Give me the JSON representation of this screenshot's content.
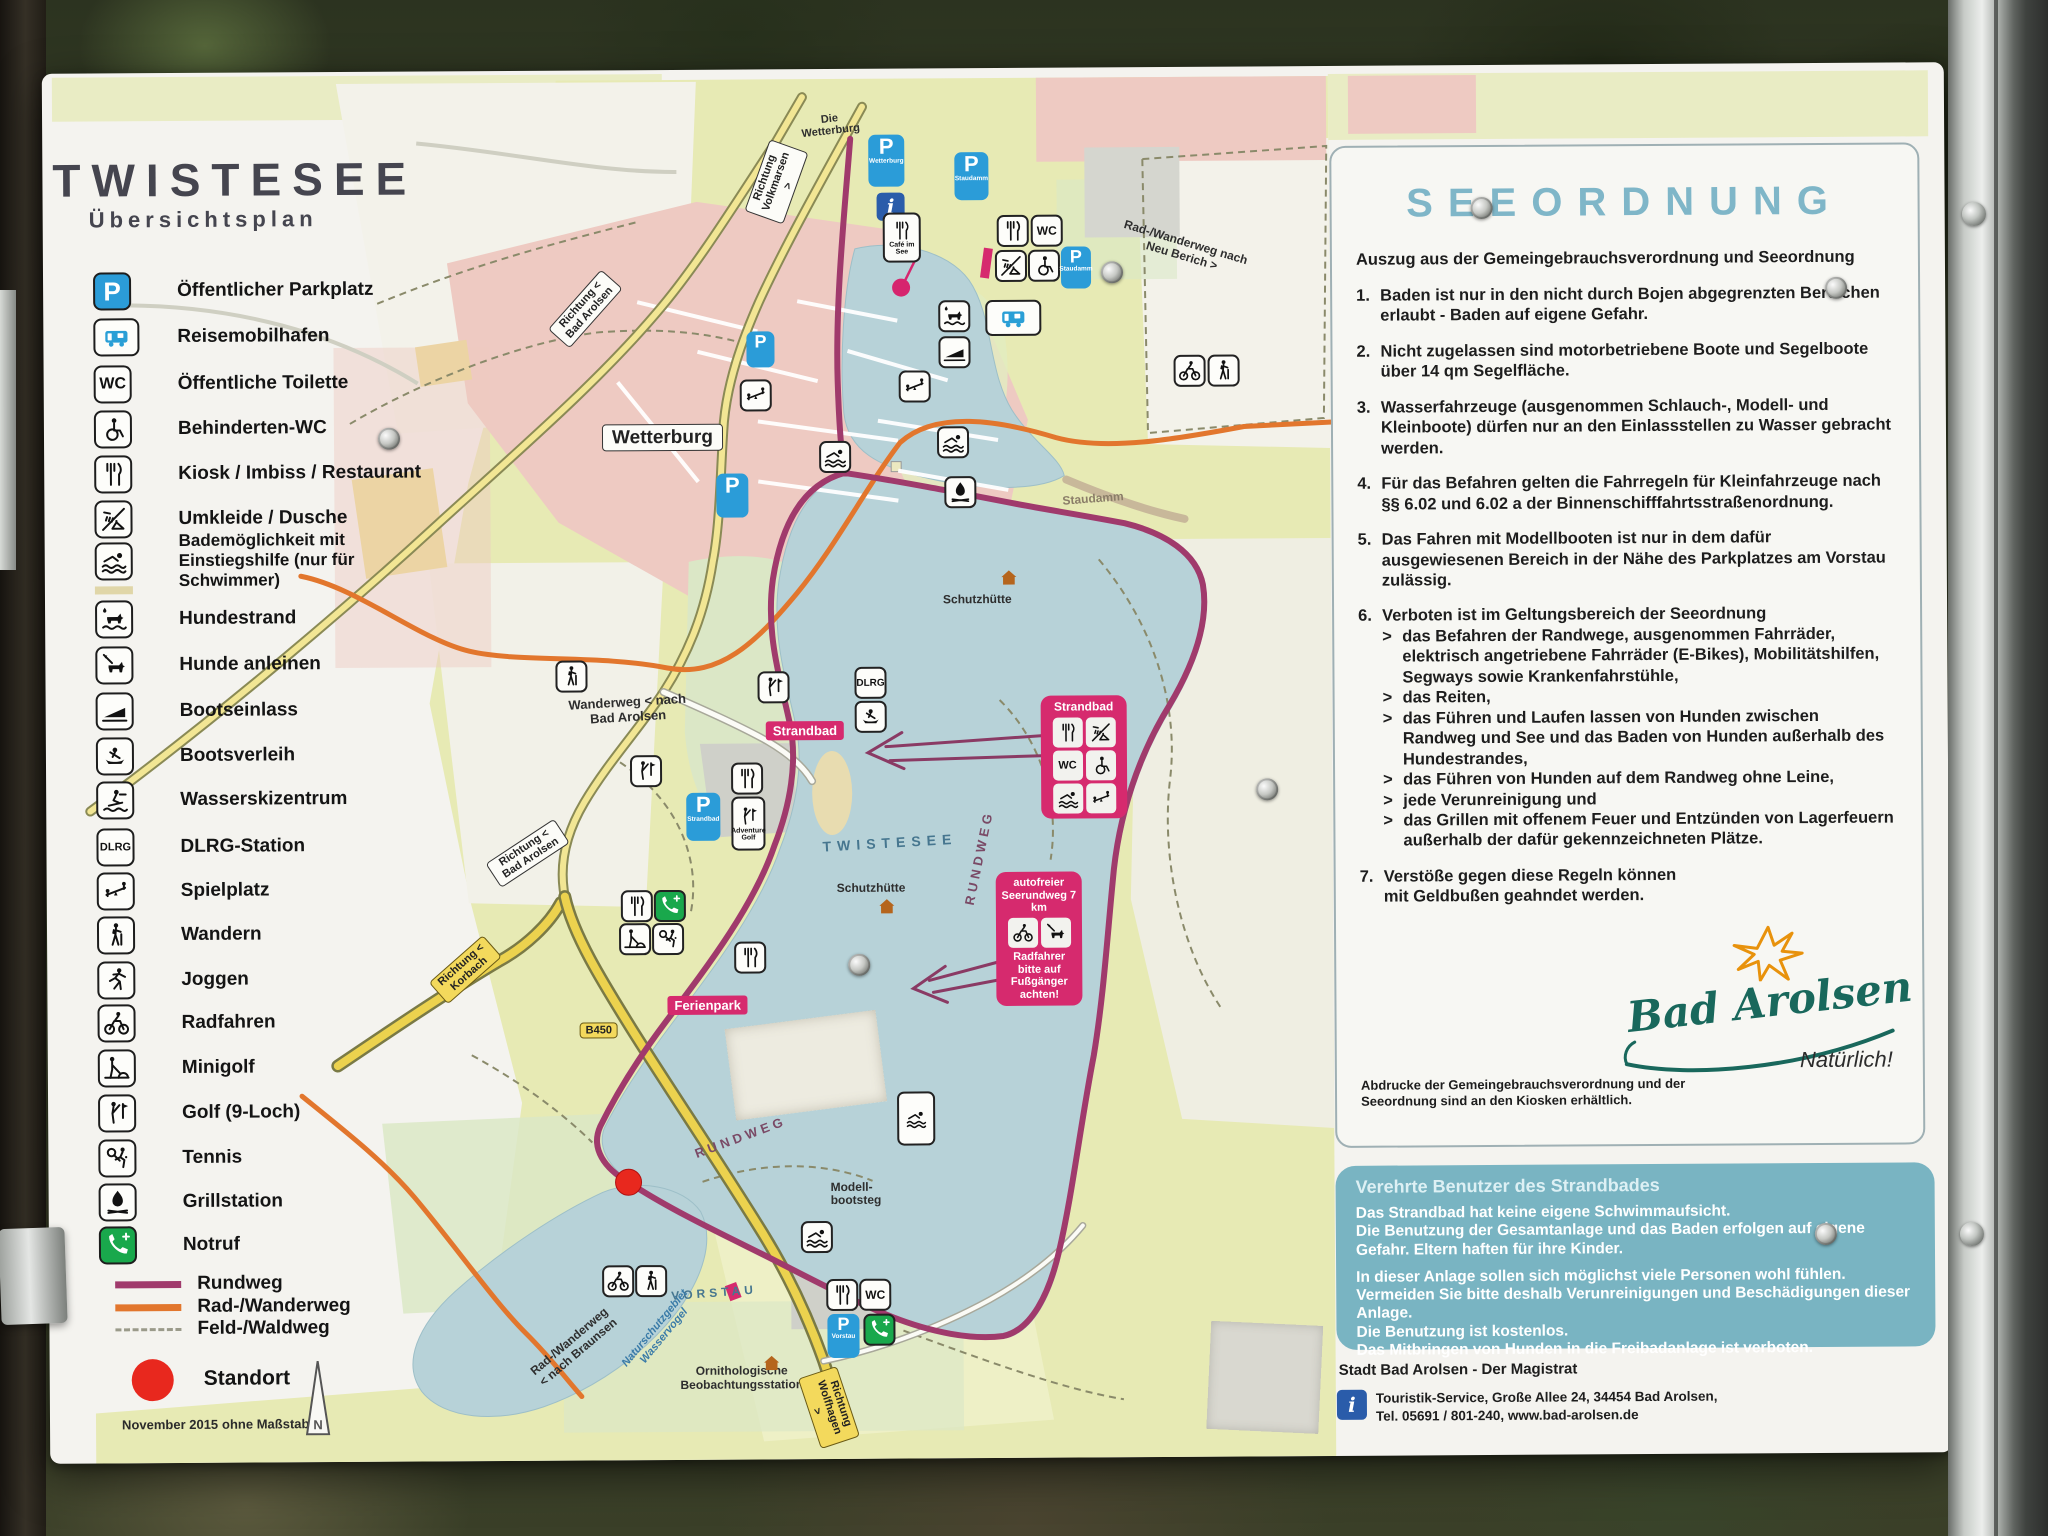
{
  "colors": {
    "seeordnung_title": "#7fb6c8",
    "notice_bg": "#79b4c2",
    "pink_box": "#d62a6e",
    "rundweg": "#a03a6c",
    "rad_wanderweg": "#e2762d",
    "feld_waldweg": "#9a9a8a",
    "standort": "#e8281e",
    "parking_blue": "#2b9cd8",
    "notruf_green": "#19a84c",
    "lake": "#b7d2d8"
  },
  "board": {
    "title": "TWISTESEE",
    "subtitle": "Übersichtsplan",
    "date": "November 2015",
    "scale_note": "ohne Maßstab"
  },
  "glyphs": {
    "p": "P",
    "wc": "WC",
    "dlrg": "DLRG",
    "fkk": "FKK",
    "i": "i",
    "north": "N"
  },
  "legend": {
    "items": [
      {
        "icon": "parking-icon",
        "label": "Öffentlicher Parkplatz"
      },
      {
        "icon": "rv-icon",
        "label": "Reisemobilhafen"
      },
      {
        "icon": "wc-icon",
        "label": "Öffentliche Toilette"
      },
      {
        "icon": "wheelchair-icon",
        "label": "Behinderten-WC"
      },
      {
        "icon": "restaurant-icon",
        "label": "Kiosk / Imbiss / Restaurant"
      },
      {
        "icon": "shower-icon",
        "label": "Umkleide / Dusche"
      },
      {
        "icon": "swimmer-icon",
        "label": "Bademöglichkeit mit Einstiegshilfe (nur für Schwimmer)"
      },
      {
        "icon": "dog-beach-icon",
        "label": "Hundestrand"
      },
      {
        "icon": "dog-leash-icon",
        "label": "Hunde anleinen"
      },
      {
        "icon": "boat-ramp-icon",
        "label": "Bootseinlass"
      },
      {
        "icon": "boat-rental-icon",
        "label": "Bootsverleih"
      },
      {
        "icon": "waterski-icon",
        "label": "Wasserskizentrum"
      },
      {
        "icon": "dlrg-icon",
        "label": "DLRG-Station"
      },
      {
        "icon": "playground-icon",
        "label": "Spielplatz"
      },
      {
        "icon": "hiking-icon",
        "label": "Wandern"
      },
      {
        "icon": "jogging-icon",
        "label": "Joggen"
      },
      {
        "icon": "cycling-icon",
        "label": "Radfahren"
      },
      {
        "icon": "minigolf-icon",
        "label": "Minigolf"
      },
      {
        "icon": "golf-icon",
        "label": "Golf (9-Loch)"
      },
      {
        "icon": "tennis-icon",
        "label": "Tennis"
      },
      {
        "icon": "grill-icon",
        "label": "Grillstation"
      },
      {
        "icon": "emergency-phone-icon",
        "label": "Notruf"
      }
    ],
    "routes": [
      {
        "label": "Rundweg",
        "color": "#a03a6c",
        "style": "solid"
      },
      {
        "label": "Rad-/Wanderweg",
        "color": "#e2762d",
        "style": "solid"
      },
      {
        "label": "Feld-/Waldweg",
        "color": "#9a9a8a",
        "style": "dashed"
      }
    ],
    "standort_label": "Standort"
  },
  "map": {
    "labels": {
      "die_wetterburg": "Die Wetterburg",
      "richtung_volkmarsen": "Richtung Volkmarsen >",
      "richtung_bad_arolsen_top": "Richtung < Bad Arolsen",
      "richtung_bad_arolsen_mid": "Richtung < Bad Arolsen",
      "richtung_korbach": "Richtung < Korbach",
      "richtung_wolfhagen": "Richtung Wolfhagen >",
      "wetterburg": "Wetterburg",
      "staudamm": "Staudamm",
      "cafe_im_see": "Café im See",
      "rad_wanderweg_neu_berich": "Rad-/Wanderweg nach Neu Berich >",
      "wanderweg_bad_arolsen": "Wanderweg < nach Bad Arolsen",
      "strandbad": "Strandbad",
      "twistesee": "TWISTESEE",
      "rundweg_east": "RUNDWEG",
      "rundweg_south": "RUNDWEG",
      "schutzhuette_1": "Schutzhütte",
      "schutzhuette_2": "Schutzhütte",
      "adventure_golf": "Adventure Golf",
      "ferienpark": "Ferienpark",
      "b450": "B450",
      "modellbootsteg": "Modell- bootsteg",
      "vorstau": "VORSTAU",
      "rad_wanderweg_braunsen": "Rad-/Wanderweg < nach Braunsen",
      "naturschutzgebiet": "Naturschutzgebiet Wasservogel",
      "ornithologische": "Ornithologische Beobachtungsstation",
      "p_wetterburg": "Wetterburg",
      "p_staudamm": "Staudamm",
      "p_strandbad": "Strandbad",
      "p_vorstau": "Vorstau"
    }
  },
  "strandbad_box": {
    "title": "Strandbad"
  },
  "seerundweg_box": {
    "title": "autofreier Seerundweg 7 km",
    "note": "Radfahrer bitte auf Fußgänger achten!"
  },
  "seeordnung": {
    "title": "SEEORDNUNG",
    "intro": "Auszug aus der Gemeingebrauchsverordnung und Seeordnung",
    "bullet": ">",
    "rules": [
      {
        "num": "1.",
        "text": "Baden ist nur in den nicht durch Bojen abgegrenzten Bereichen erlaubt - Baden auf eigene Gefahr."
      },
      {
        "num": "2.",
        "text": "Nicht zugelassen sind motorbetriebene Boote und Segelboote über 14 qm Segelfläche."
      },
      {
        "num": "3.",
        "text": "Wasserfahrzeuge (ausgenommen Schlauch-, Modell- und Kleinboote) dürfen nur an den Einlassstellen zu Wasser gebracht werden."
      },
      {
        "num": "4.",
        "text": "Für das Befahren gelten die Fahrregeln für Kleinfahrzeuge nach §§ 6.02 und 6.02 a der Binnenschifffahrtsstraßenordnung."
      },
      {
        "num": "5.",
        "text": "Das Fahren mit Modellbooten ist nur in dem dafür ausgewiesenen Bereich in der Nähe des Parkplatzes am Vorstau zulässig."
      },
      {
        "num": "6.",
        "text": "Verboten ist im Geltungsbereich der Seeordnung"
      },
      {
        "num": "7.",
        "text": "Verstöße gegen diese Regeln können mit Geldbußen geahndet werden."
      }
    ],
    "rule6_subs": [
      "das Befahren der Randwege, ausgenommen Fahrräder, elektrisch angetriebene Fahrräder (E-Bikes), Mobilitätshilfen, Segways sowie Krankenfahrstühle,",
      "das Reiten,",
      "das Führen und Laufen lassen von Hunden zwischen Randweg und See und das Baden von Hunden außerhalb des Hundestrandes,",
      "das Führen von Hunden auf dem Randweg ohne Leine,",
      "jede Verunreinigung und",
      "das Grillen mit offenem Feuer und Entzünden von Lagerfeuern außerhalb der dafür gekennzeichneten Plätze."
    ],
    "note": "Abdrucke der Gemeingebrauchsverordnung und der Seeordnung sind an den Kiosken erhältlich."
  },
  "branding": {
    "name": "Bad Arolsen",
    "tagline": "Natürlich!"
  },
  "notice": {
    "heading": "Verehrte Benutzer des Strandbades",
    "paras": [
      "Das Strandbad hat keine eigene Schwimmaufsicht.",
      "Die Benutzung der Gesamtanlage und das Baden erfolgen auf eigene Gefahr. Eltern haften für ihre Kinder.",
      "In dieser Anlage sollen sich möglichst viele Personen wohl fühlen. Vermeiden Sie bitte deshalb Verunreinigungen und Beschädigungen dieser Anlage.",
      "Die Benutzung ist kostenlos.",
      "Das Mitbringen von Hunden in die Freibadanlage ist verboten."
    ]
  },
  "footer": {
    "line1": "Stadt Bad Arolsen - Der Magistrat",
    "line2": "Touristik-Service, Große Allee 24, 34454 Bad Arolsen,",
    "line3": "Tel. 05691 / 801-240, www.bad-arolsen.de"
  }
}
